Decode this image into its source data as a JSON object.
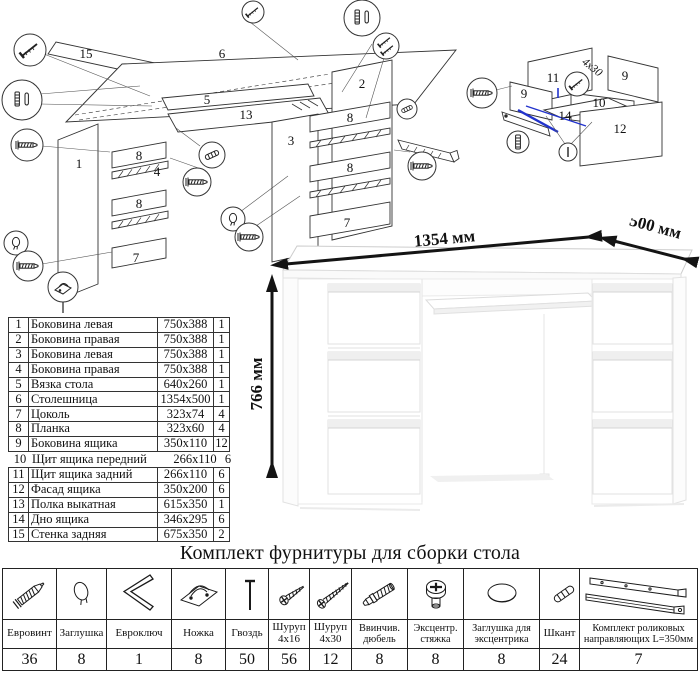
{
  "exploded_main": {
    "part_labels": {
      "p15": "15",
      "p6": "6",
      "p5": "5",
      "p13": "13",
      "p1": "1",
      "p8a": "8",
      "p4": "4",
      "p8b": "8",
      "p7a": "7",
      "p3": "3",
      "p2": "2",
      "p8c": "8",
      "p8d": "8",
      "p7b": "7"
    }
  },
  "exploded_drawer": {
    "part_labels": {
      "p11": "11",
      "p9a": "9",
      "p9b": "9",
      "p10": "10",
      "p14": "14",
      "p12": "12"
    },
    "screw_note": "4x30"
  },
  "dimensions": {
    "width": "1354 мм",
    "depth": "500 мм",
    "height": "766 мм"
  },
  "parts_table": {
    "rows": [
      {
        "num": "1",
        "name": "Боковина левая",
        "size": "750x388",
        "qty": "1"
      },
      {
        "num": "2",
        "name": "Боковина правая",
        "size": "750x388",
        "qty": "1"
      },
      {
        "num": "3",
        "name": "Боковина левая",
        "size": "750x388",
        "qty": "1"
      },
      {
        "num": "4",
        "name": "Боковина правая",
        "size": "750x388",
        "qty": "1"
      },
      {
        "num": "5",
        "name": "Вязка стола",
        "size": "640x260",
        "qty": "1"
      },
      {
        "num": "6",
        "name": "Столешница",
        "size": "1354x500",
        "qty": "1"
      },
      {
        "num": "7",
        "name": "Цоколь",
        "size": "323x74",
        "qty": "4"
      },
      {
        "num": "8",
        "name": "Планка",
        "size": "323x60",
        "qty": "4"
      },
      {
        "num": "9",
        "name": "Боковина ящика",
        "size": "350x110",
        "qty": "12"
      },
      {
        "num": "10",
        "name": "Щит ящика передний",
        "size": "266x110",
        "qty": "6"
      },
      {
        "num": "11",
        "name": "Щит ящика задний",
        "size": "266x110",
        "qty": "6"
      },
      {
        "num": "12",
        "name": "Фасад ящика",
        "size": "350x200",
        "qty": "6"
      },
      {
        "num": "13",
        "name": "Полка выкатная",
        "size": "615x350",
        "qty": "1"
      },
      {
        "num": "14",
        "name": "Дно ящика",
        "size": "346x295",
        "qty": "6"
      },
      {
        "num": "15",
        "name": "Стенка задняя",
        "size": "675x350",
        "qty": "2"
      }
    ]
  },
  "hardware_kit": {
    "title": "Комплект фурнитуры для сборки стола",
    "items": [
      {
        "name": "Евровинт",
        "qty": "36",
        "icon": "euro-screw-icon"
      },
      {
        "name": "Заглушка",
        "qty": "8",
        "icon": "cap-icon"
      },
      {
        "name": "Евроключ",
        "qty": "1",
        "icon": "hex-key-icon"
      },
      {
        "name": "Ножка",
        "qty": "8",
        "icon": "foot-icon"
      },
      {
        "name": "Гвоздь",
        "qty": "50",
        "icon": "nail-icon"
      },
      {
        "name": "Шуруп 4x16",
        "qty": "56",
        "icon": "screw-small-icon"
      },
      {
        "name": "Шуруп 4x30",
        "qty": "12",
        "icon": "screw-large-icon"
      },
      {
        "name": "Ввинчив. дюбель",
        "qty": "8",
        "icon": "threaded-dowel-icon"
      },
      {
        "name": "Эксцентр. стяжка",
        "qty": "8",
        "icon": "cam-lock-icon"
      },
      {
        "name": "Заглушка для эксцентрика",
        "qty": "8",
        "icon": "cam-cap-icon"
      },
      {
        "name": "Шкант",
        "qty": "24",
        "icon": "dowel-icon"
      },
      {
        "name": "Комплект роликовых направляющих L=350мм",
        "qty": "7",
        "icon": "drawer-slides-icon"
      }
    ]
  }
}
